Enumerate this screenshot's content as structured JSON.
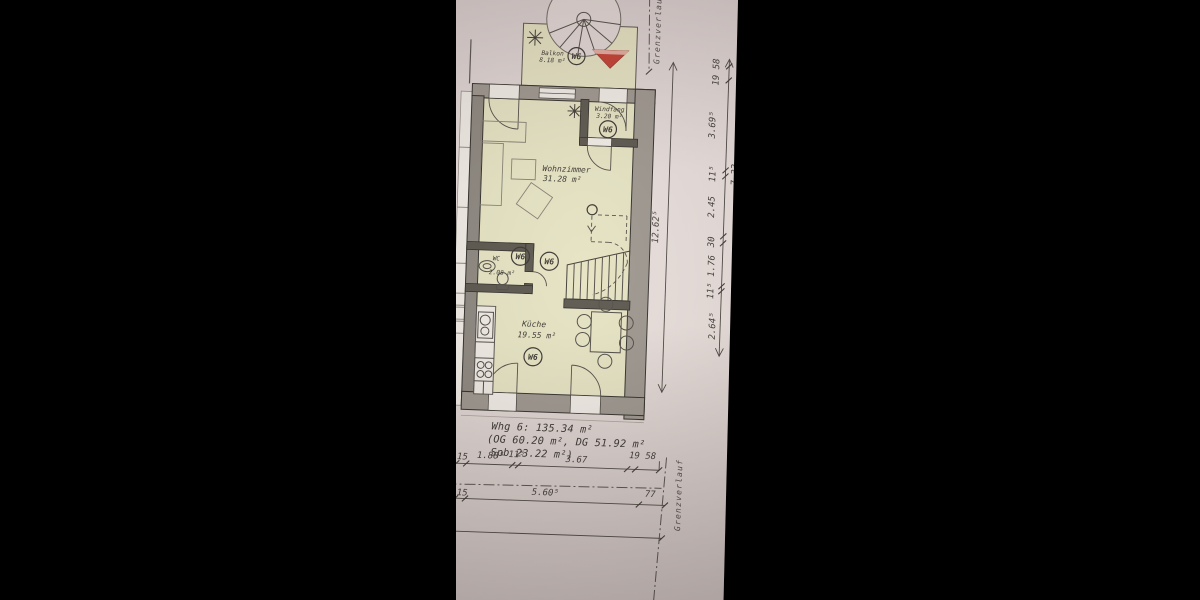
{
  "photo": {
    "paper_color": "#e4dad7",
    "room_fill": "#e5e2c1",
    "wall_fill": "#9b948c",
    "accent_red": "#c23a2c"
  },
  "plan": {
    "unit_label": "W6",
    "rooms": {
      "balkon": {
        "name": "Balkon",
        "area": "8.18 m²"
      },
      "windfang": {
        "name": "Windfang",
        "area": "3.20 m²"
      },
      "wohnzimmer": {
        "name": "Wohnzimmer",
        "area": "31.28 m²"
      },
      "wc": {
        "name": "WC",
        "area": "2.08 m²"
      },
      "kueche": {
        "name": "Küche",
        "area": "19.55 m²"
      }
    },
    "summary": {
      "line1": "Whg 6: 135.34 m²",
      "line2": "(OG 60.20 m², DG 51.92 m²",
      "line3": "Spb 23.22 m²)"
    },
    "boundary_label": "Grenzverlauf",
    "dims": {
      "right_detail": [
        "19 58",
        "3.69⁵",
        "11⁵",
        "2.45",
        "30",
        "1.76",
        "11⁵",
        "2.64⁵"
      ],
      "right_overall": "12.62⁵",
      "right_subtotal": "7.33",
      "bottom_row1": [
        "4",
        "15",
        "1.88⁵",
        "11⁵",
        "3.67",
        "19 58"
      ],
      "bottom_row2": [
        "4",
        "15",
        "5.60⁵",
        "77"
      ]
    }
  }
}
